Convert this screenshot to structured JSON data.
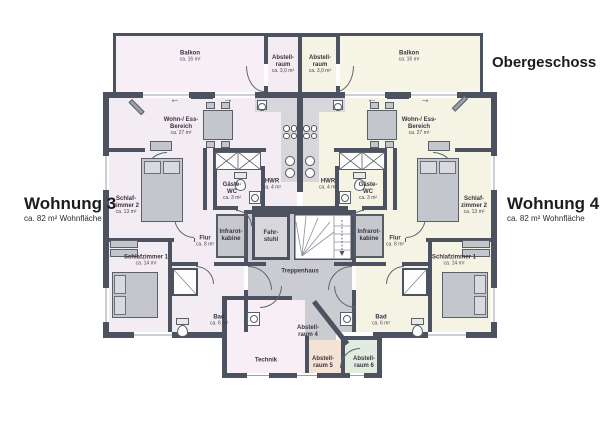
{
  "title": "Obergeschoss",
  "apartments": {
    "left": {
      "name": "Wohnung 3",
      "area": "ca. 82 m² Wohnfläche"
    },
    "right": {
      "name": "Wohnung 4",
      "area": "ca. 82 m² Wohnfläche"
    }
  },
  "rooms": {
    "balkon_left": {
      "name": "Balkon",
      "area": "ca. 16 m²"
    },
    "balkon_right": {
      "name": "Balkon",
      "area": "ca. 16 m²"
    },
    "abstellraum_top_left": {
      "name": "Abstell-raum",
      "area": "ca. 3,0 m²"
    },
    "abstellraum_top_right": {
      "name": "Abstell-raum",
      "area": "ca. 3,0 m²"
    },
    "wohn_ess_left": {
      "name": "Wohn-/ Ess-Bereich",
      "area": "ca. 27 m²"
    },
    "wohn_ess_right": {
      "name": "Wohn-/ Ess-Bereich",
      "area": "ca. 27 m²"
    },
    "hwr_left": {
      "name": "HWR",
      "area": "ca. 4 m²"
    },
    "hwr_right": {
      "name": "HWR",
      "area": "ca. 4 m²"
    },
    "gaeste_wc_left": {
      "name": "Gäste- WC",
      "area": "ca. 3 m²"
    },
    "gaeste_wc_right": {
      "name": "Gäste- WC",
      "area": "ca. 3 m²"
    },
    "infrarot_left": {
      "name": "Infrarot-kabine"
    },
    "infrarot_right": {
      "name": "Infrarot-kabine"
    },
    "fahrstuhl": {
      "name": "Fahr-stuhl"
    },
    "treppenhaus": {
      "name": "Treppenhaus"
    },
    "flur_left": {
      "name": "Flur",
      "area": "ca. 8 m²"
    },
    "flur_right": {
      "name": "Flur",
      "area": "ca. 8 m²"
    },
    "schlafzimmer2_left": {
      "name": "Schlaf-zimmer 2",
      "area": "ca. 13 m²"
    },
    "schlafzimmer2_right": {
      "name": "Schlaf-zimmer 2",
      "area": "ca. 13 m²"
    },
    "schlafzimmer1_left": {
      "name": "Schlafzimmer 1",
      "area": "ca. 14 m²"
    },
    "schlafzimmer1_right": {
      "name": "Schlafzimmer 1",
      "area": "ca. 14 m²"
    },
    "bad_left": {
      "name": "Bad",
      "area": "ca. 6 m²"
    },
    "bad_right": {
      "name": "Bad",
      "area": "ca. 6 m²"
    },
    "technik": {
      "name": "Technik"
    },
    "abstellraum4": {
      "name": "Abstell-raum 4"
    },
    "abstellraum5": {
      "name": "Abstell-raum 5"
    },
    "abstellraum6": {
      "name": "Abstell-raum 6"
    }
  },
  "arrows": {
    "left": "←",
    "right": "→"
  },
  "colors": {
    "wall": "#4c5260",
    "apartment_left_fill": "#f3ecf2",
    "apartment_right_fill": "#f5f3e3",
    "stairwell_fill": "#cbccd2",
    "abstellraum5_fill": "#f4e3d4",
    "abstellraum6_fill": "#e1ece0",
    "label_text": "#3b3342"
  }
}
